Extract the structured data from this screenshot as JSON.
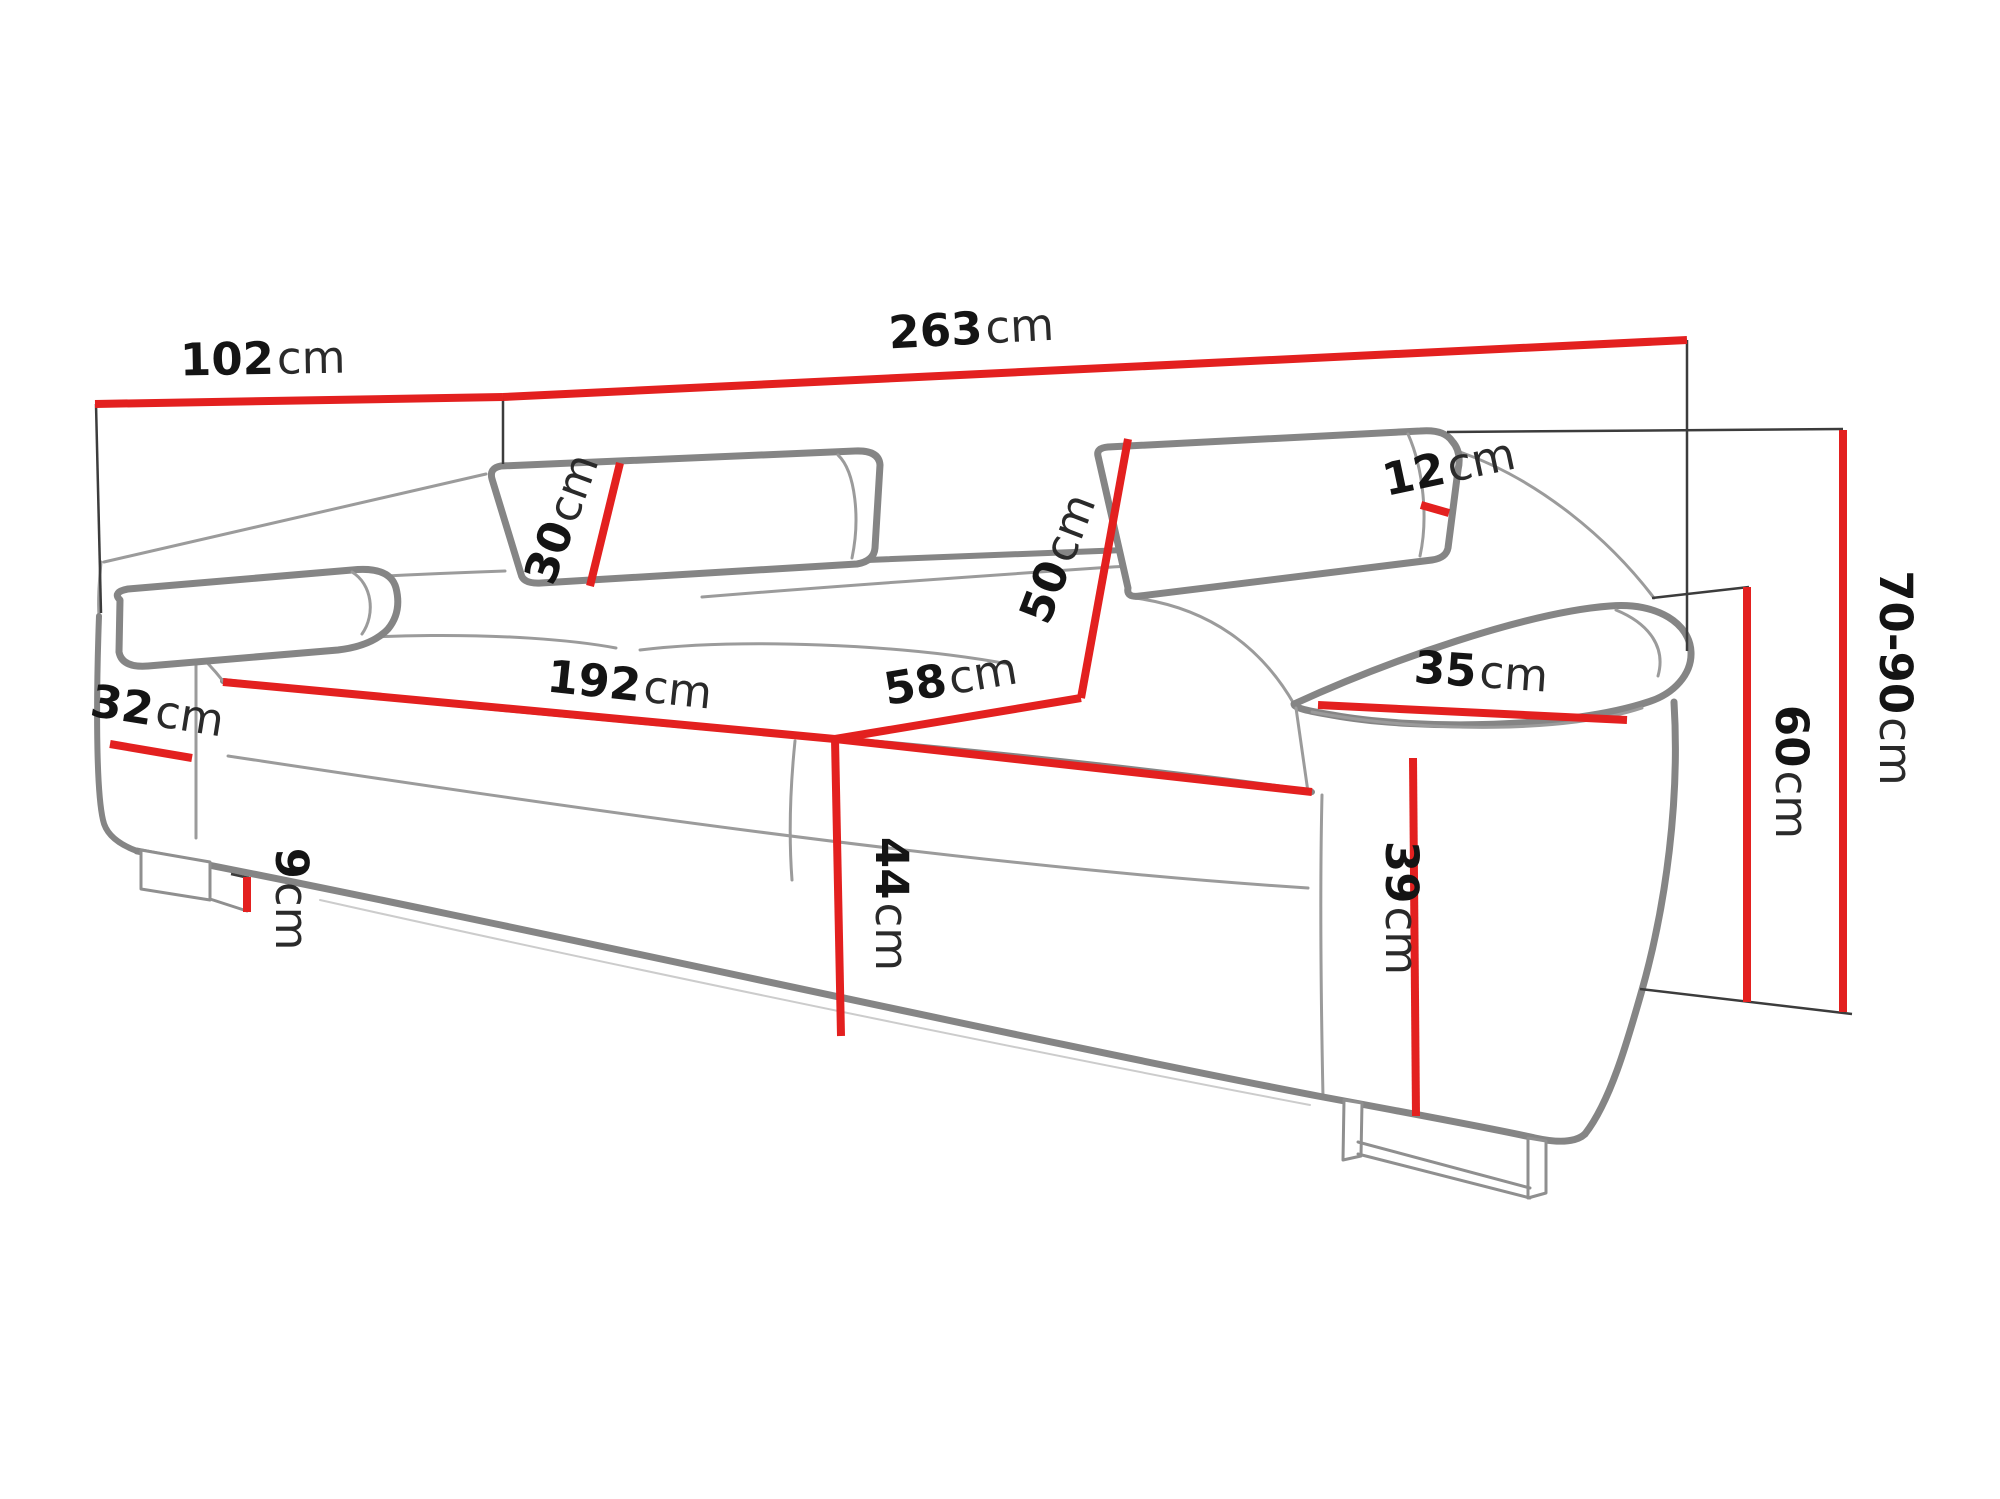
{
  "diagram": {
    "type": "furniture-dimension-diagram",
    "subject": "three-seat sofa with adjustable headrests and metal legs",
    "unit": "cm",
    "colors": {
      "dimension_line": "#e3201f",
      "drawing_line": "#858585",
      "extension_line": "#3c3c3c",
      "text": "#141414",
      "background": "#ffffff"
    }
  },
  "dims": {
    "sofa_depth": {
      "value": "102",
      "unit": "cm"
    },
    "sofa_width": {
      "value": "263",
      "unit": "cm"
    },
    "headrest_thickness": {
      "value": "12",
      "unit": "cm"
    },
    "headrest_height": {
      "value": "30",
      "unit": "cm"
    },
    "backrest_height": {
      "value": "50",
      "unit": "cm"
    },
    "seat_width": {
      "value": "192",
      "unit": "cm"
    },
    "seat_depth": {
      "value": "58",
      "unit": "cm"
    },
    "right_armrest_width": {
      "value": "35",
      "unit": "cm"
    },
    "left_armrest_width": {
      "value": "32",
      "unit": "cm"
    },
    "seat_height": {
      "value": "44",
      "unit": "cm"
    },
    "leg_height": {
      "value": "9",
      "unit": "cm"
    },
    "armrest_height": {
      "value": "39",
      "unit": "cm"
    },
    "armrest_floor_height": {
      "value": "60",
      "unit": "cm"
    },
    "total_height": {
      "value": "70-90",
      "unit": "cm"
    }
  }
}
